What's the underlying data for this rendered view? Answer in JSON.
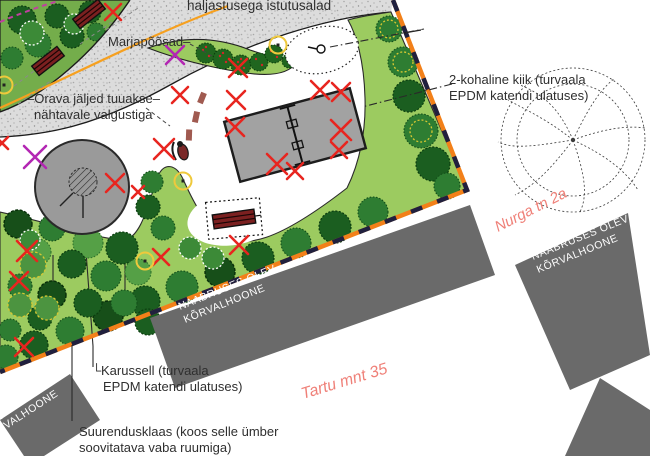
{
  "colors": {
    "lawn_green": "#9ccb60",
    "forest_green": "#74ad4b",
    "path_gray": "#dcdcdc",
    "epdm_gray": "#a2a2a2",
    "carousel_gray": "#9a9a9a",
    "building_gray": "#6a6a6a",
    "boundary_orange": "#f28019",
    "boundary_navy": "#20203e",
    "removal_x_red": "#e8251f",
    "relocate_x_purple": "#b327b3",
    "street_label_red": "#ef8078",
    "light_circle_yellow": "#efc93c",
    "bench_red": "#7b2020",
    "label_dark": "#2f2f2f",
    "path_line_orange": "#f6a01f"
  },
  "labels": {
    "planting_area": "haljastusega istutusalad",
    "berry_bushes": "Marjapõõsad–",
    "squirrel_tracks_line1": "–Orava jäljed tuuakse–",
    "squirrel_tracks_line2": "nähtavale valgustiga",
    "swing_line1": "2-kohaline kiik (turvaala",
    "swing_line2": "EPDM katendi ulatuses)",
    "street_nurga": "Nurga tn 2a",
    "street_tartu": "Tartu mnt 35",
    "neighbor_line1": "NAABRUSES OLEV",
    "neighbor_line2": "KÕRVALHOONE",
    "neighbor3_line1": "NAABRUSES",
    "neighbor3_line2": "OLEV",
    "neighbor3_line3": "KÕRVALHOONE",
    "carousel_elbow": "└",
    "carousel_line1": "Karussell (turvaala",
    "carousel_line2": "EPDM katendi ulatuses)",
    "magnifier_line1": "Suurendusklaas (koos selle ümber",
    "magnifier_line2": "soovitatava vaba ruumiga)"
  },
  "markers": {
    "red_x": [
      [
        113,
        12,
        8
      ],
      [
        238,
        68,
        9
      ],
      [
        180,
        95,
        8
      ],
      [
        236,
        100,
        9
      ],
      [
        320,
        90,
        9
      ],
      [
        341,
        92,
        9
      ],
      [
        235,
        127,
        9
      ],
      [
        341,
        130,
        10
      ],
      [
        339,
        150,
        8
      ],
      [
        164,
        149,
        10
      ],
      [
        115,
        183,
        9
      ],
      [
        138,
        192,
        6
      ],
      [
        277,
        164,
        10
      ],
      [
        295,
        171,
        8
      ],
      [
        239,
        245,
        9
      ],
      [
        161,
        257,
        8
      ],
      [
        27,
        251,
        10
      ],
      [
        19,
        281,
        9
      ],
      [
        24,
        347,
        9
      ],
      [
        2,
        143,
        6
      ]
    ],
    "purple_x": [
      [
        175,
        55,
        9
      ],
      [
        35,
        157,
        11
      ]
    ],
    "lights": [
      [
        278,
        45
      ],
      [
        183,
        181
      ],
      [
        145,
        261
      ],
      [
        4,
        85
      ]
    ]
  }
}
